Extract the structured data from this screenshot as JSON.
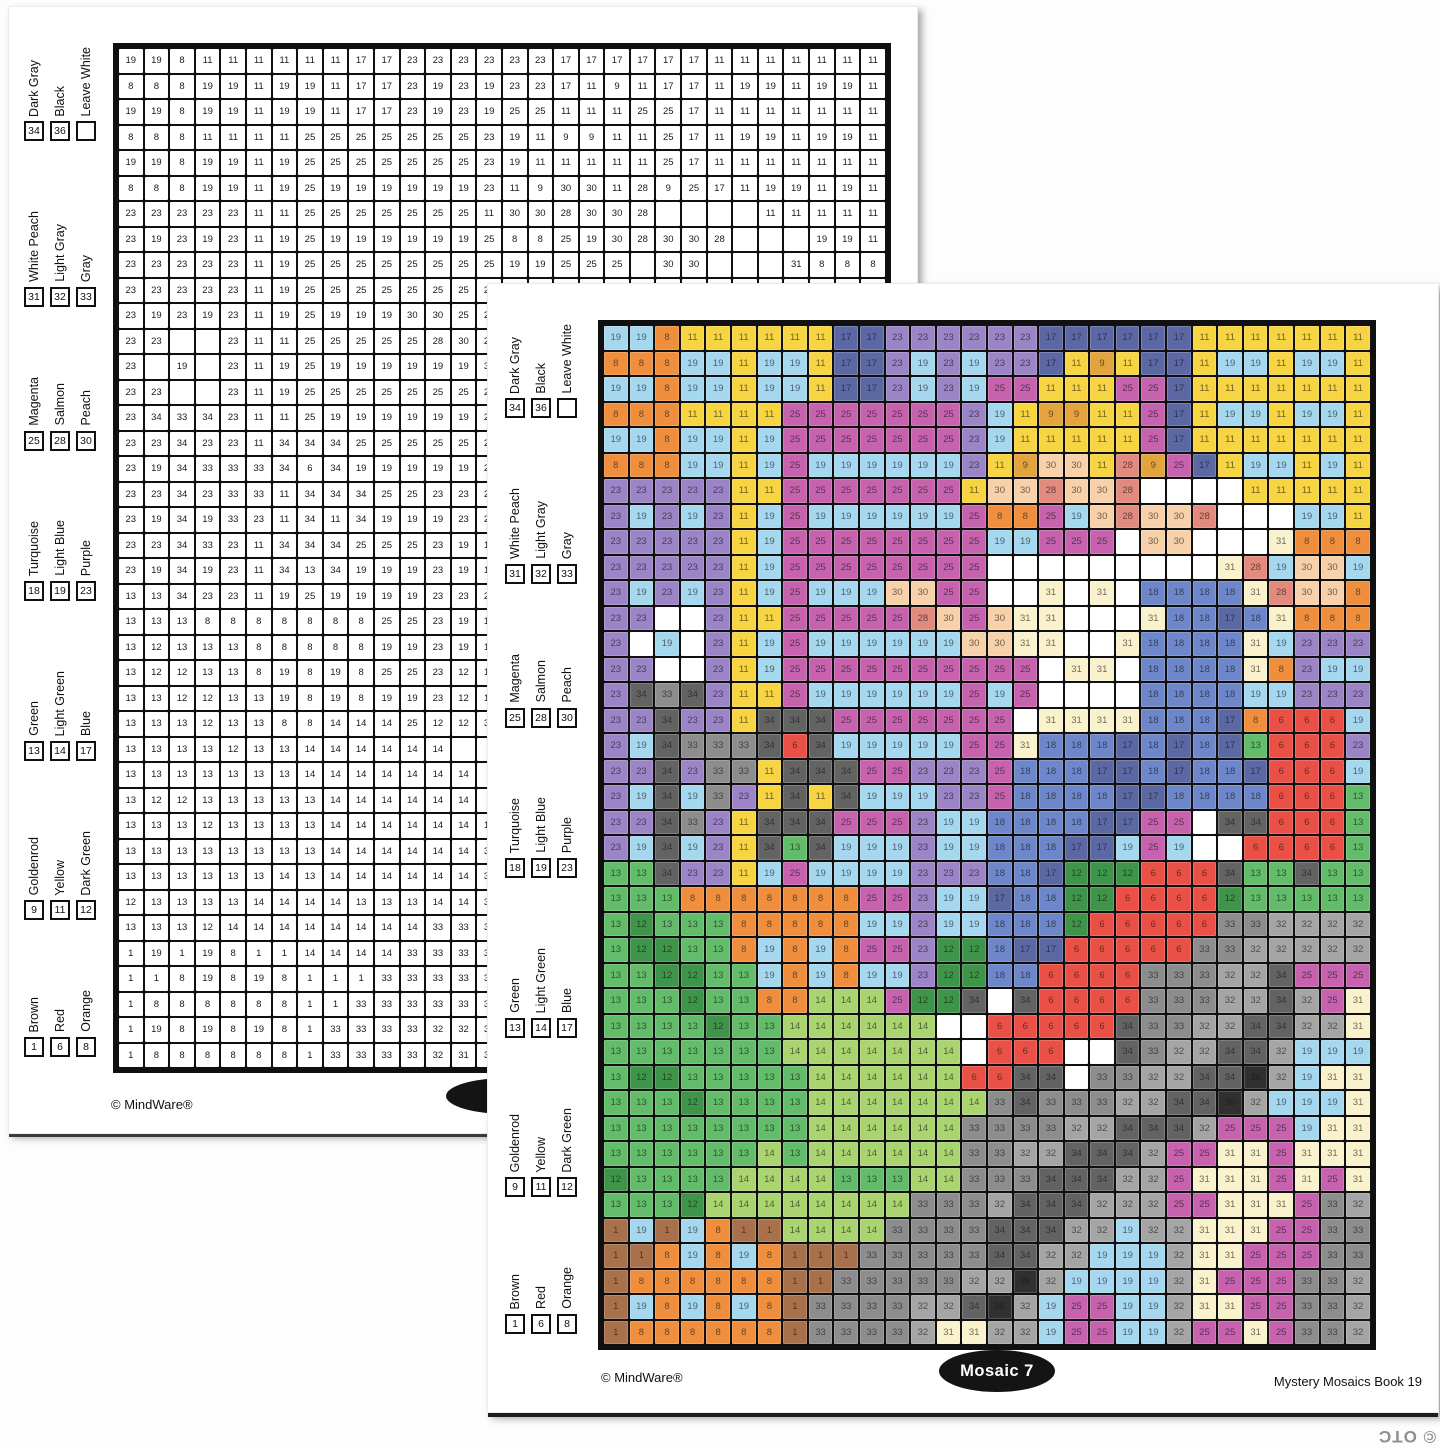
{
  "palette": {
    "1": {
      "name": "Brown",
      "hex": "#a8714c"
    },
    "6": {
      "name": "Red",
      "hex": "#ea5046"
    },
    "8": {
      "name": "Orange",
      "hex": "#ef8f3e"
    },
    "9": {
      "name": "Goldenrod",
      "hex": "#e3a33d"
    },
    "11": {
      "name": "Yellow",
      "hex": "#f7d442"
    },
    "12": {
      "name": "Dark Green",
      "hex": "#3e9549"
    },
    "13": {
      "name": "Green",
      "hex": "#62bc69"
    },
    "14": {
      "name": "Light Green",
      "hex": "#aad46f"
    },
    "17": {
      "name": "Blue",
      "hex": "#5c68a4"
    },
    "18": {
      "name": "Turquoise",
      "hex": "#6e86ca"
    },
    "19": {
      "name": "Light Blue",
      "hex": "#a5d8ee"
    },
    "23": {
      "name": "Purple",
      "hex": "#9c85c6"
    },
    "25": {
      "name": "Magenta",
      "hex": "#c763ae"
    },
    "28": {
      "name": "Salmon",
      "hex": "#e28a7e"
    },
    "30": {
      "name": "Peach",
      "hex": "#f7d1a9"
    },
    "31": {
      "name": "White Peach",
      "hex": "#f9f2cd"
    },
    "32": {
      "name": "Light Gray",
      "hex": "#a5a5a5"
    },
    "33": {
      "name": "Gray",
      "hex": "#8d8d8d"
    },
    "34": {
      "name": "Dark Gray",
      "hex": "#636363"
    },
    "36": {
      "name": "Black",
      "hex": "#303030"
    }
  },
  "legend": {
    "groups": [
      {
        "entries": [
          {
            "code": "34",
            "label": "Dark Gray"
          },
          {
            "code": "36",
            "label": "Black"
          },
          {
            "code": "",
            "label": "Leave White"
          }
        ]
      },
      {
        "entries": [
          {
            "code": "31",
            "label": "White Peach"
          },
          {
            "code": "32",
            "label": "Light Gray"
          },
          {
            "code": "33",
            "label": "Gray"
          }
        ]
      },
      {
        "entries": [
          {
            "code": "25",
            "label": "Magenta"
          },
          {
            "code": "28",
            "label": "Salmon"
          },
          {
            "code": "30",
            "label": "Peach"
          }
        ]
      },
      {
        "entries": [
          {
            "code": "18",
            "label": "Turquoise"
          },
          {
            "code": "19",
            "label": "Light Blue"
          },
          {
            "code": "23",
            "label": "Purple"
          }
        ]
      },
      {
        "entries": [
          {
            "code": "13",
            "label": "Green"
          },
          {
            "code": "14",
            "label": "Light Green"
          },
          {
            "code": "17",
            "label": "Blue"
          }
        ]
      },
      {
        "entries": [
          {
            "code": "9",
            "label": "Goldenrod"
          },
          {
            "code": "11",
            "label": "Yellow"
          },
          {
            "code": "12",
            "label": "Dark Green"
          }
        ]
      },
      {
        "entries": [
          {
            "code": "1",
            "label": "Brown"
          },
          {
            "code": "6",
            "label": "Red"
          },
          {
            "code": "8",
            "label": "Orange"
          }
        ]
      }
    ]
  },
  "grid": {
    "rows": 40,
    "cols": 30,
    "cells": [
      "19 19 8 11 11 11 11 11 11 17 17 23 23 23 23 23 23 17 17 17 17 17 17 11 11 11 11 11 11 11",
      "8 8 8 19 19 11 19 19 11 17 17 23 19 23 19 23 23 17 11 9 11 17 17 11 19 19 11 19 19 11",
      "19 19 8 19 19 11 19 19 11 17 17 23 19 23 19 25 25 11 11 11 25 25 17 11 11 11 11 11 11 11",
      "8 8 8 11 11 11 11 25 25 25 25 25 25 25 23 19 11 9 9 11 11 25 17 11 19 19 11 19 19 11",
      "19 19 8 19 19 11 19 25 25 25 25 25 25 25 23 19 11 11 11 11 11 25 17 11 11 11 11 11 11 11",
      "8 8 8 19 19 11 19 25 19 19 19 19 19 19 23 11 9 30 30 11 28 9 25 17 11 19 19 11 19 11",
      "23 23 23 23 23 11 11 25 25 25 25 25 25 25 11 30 30 28 30 30 28 0 0 0 0 11 11 11 11 11",
      "23 19 23 19 23 11 19 25 19 19 19 19 19 19 25 8 8 25 19 30 28 30 30 28 0 0 0 19 19 11",
      "23 23 23 23 23 11 19 25 25 25 25 25 25 25 25 19 19 25 25 25 0 30 30 0 0 0 31 8 8 8",
      "23 23 23 23 23 11 19 25 25 25 25 25 25 25 25 0 0 0 0 0 0 0 0 0 31 28 19 30 30 19",
      "23 19 23 19 23 11 19 25 19 19 19 30 30 25 25 0 0 31 0 31 0 18 18 18 18 31 28 30 30 8",
      "23 23 0 0 23 11 11 25 25 25 25 25 28 30 25 30 31 31 0 0 0 31 18 18 17 18 31 8 8 8",
      "23 0 19 0 23 11 19 25 19 19 19 19 19 19 30 30 31 31 0 0 31 18 18 18 18 31 19 23 23 23",
      "23 23 0 0 23 11 19 25 25 25 25 25 25 25 25 25 25 0 31 31 0 18 18 18 18 31 8 23 19 19",
      "23 34 33 34 23 11 11 25 19 19 19 19 19 19 25 19 25 0 0 0 0 18 18 18 18 19 19 23 23 23",
      "23 23 34 23 23 11 34 34 34 25 25 25 25 25 25 25 0 31 31 31 31 18 18 18 17 8 6 6 6 19",
      "23 19 34 33 33 33 34 6 34 19 19 19 19 19 25 25 31 18 18 18 17 18 17 18 17 13 6 6 6 23",
      "23 23 34 23 33 33 11 34 34 34 25 25 23 23 23 25 18 18 18 17 17 18 17 18 18 17 6 6 6 19",
      "23 19 34 19 33 23 11 34 11 34 19 19 19 23 23 25 18 18 18 18 17 17 18 18 18 18 6 6 6 13",
      "23 23 34 33 23 11 34 34 34 25 25 25 23 19 19 18 18 18 18 17 17 25 25 0 34 34 6 6 6 13",
      "23 19 34 19 23 11 34 13 34 19 19 19 23 19 19 18 18 18 17 17 19 25 19 0 0 6 6 6 6 13",
      "13 13 34 23 23 11 19 25 19 19 19 19 23 23 23 18 18 17 12 12 12 6 6 6 34 13 13 34 13 13",
      "13 13 13 8 8 8 8 8 8 8 25 25 23 19 19 17 18 18 12 12 6 6 6 6 12 13 13 13 13 13",
      "13 12 13 13 13 8 8 8 8 8 19 19 23 19 19 18 18 18 12 6 6 6 6 6 33 33 32 32 32 32",
      "13 12 12 13 13 8 19 8 19 8 25 25 23 12 12 18 17 17 6 6 6 6 6 33 33 32 32 32 32 32",
      "13 13 12 12 13 13 19 8 19 8 19 19 23 12 12 18 18 6 6 6 6 33 33 33 32 32 34 25 25 25",
      "13 13 13 12 13 13 8 8 14 14 14 25 12 12 34 0 34 6 6 6 6 33 33 33 32 32 34 32 25 31",
      "13 13 13 13 12 13 13 14 14 14 14 14 14 0 0 6 6 6 6 6 34 33 33 32 32 34 34 32 32 31",
      "13 13 13 13 13 13 13 14 14 14 14 14 14 14 0 6 6 6 0 0 34 33 32 32 34 34 32 19 19 19",
      "13 12 12 13 13 13 13 13 14 14 14 14 14 14 6 6 34 34 0 33 33 32 32 34 34 36 32 19 31 31",
      "13 13 13 12 13 13 13 13 14 14 14 14 14 14 14 33 34 33 33 33 32 32 34 34 36 32 19 19 19 31",
      "13 13 13 13 13 13 13 13 14 14 14 14 14 14 33 33 33 33 32 32 34 34 34 32 25 25 25 19 31 31",
      "13 13 13 13 13 13 14 13 14 14 14 14 14 14 33 33 32 32 34 34 34 32 25 25 31 31 25 31 31 31",
      "12 13 13 13 13 14 14 14 14 13 13 13 14 14 33 33 33 34 34 34 32 32 25 31 31 31 25 31 25 31",
      "13 13 13 12 14 14 14 14 14 14 14 14 33 33 33 32 34 34 34 32 32 32 25 25 31 31 31 25 33 32",
      "1 19 1 19 8 1 1 14 14 14 14 33 33 33 33 34 34 34 32 32 19 32 32 31 31 31 25 25 33 33",
      "1 1 8 19 8 19 8 1 1 1 33 33 33 33 33 34 34 32 32 19 19 19 32 31 31 25 25 25 33 33",
      "1 8 8 8 8 8 8 1 1 33 33 33 33 33 32 32 36 32 19 19 19 19 32 31 25 25 25 33 33 32",
      "1 19 8 19 8 19 8 1 33 33 33 33 32 32 34 36 32 19 25 25 19 19 32 31 31 25 25 33 33 32",
      "1 8 8 8 8 8 8 1 33 33 33 33 32 31 31 32 32 19 25 25 19 19 32 25 25 31 25 33 33 32"
    ]
  },
  "back_page": {
    "footer_left": "© MindWare®"
  },
  "front_page": {
    "footer_left": "© MindWare®",
    "badge_label": "Mosaic 7",
    "footer_right": "Mystery Mosaics Book 19"
  },
  "watermark": "© OTC"
}
